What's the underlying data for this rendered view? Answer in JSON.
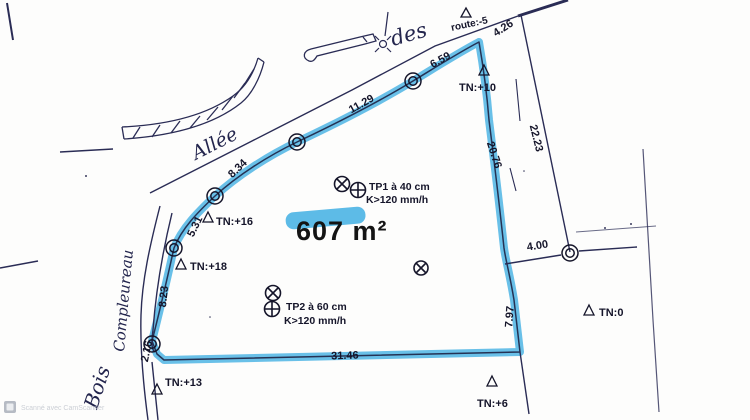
{
  "colors": {
    "highlighter": "#2fa8e0",
    "ink": "#23254d"
  },
  "parcel": {
    "area_label": "607 m²"
  },
  "labels": {
    "street_allee": "Allée",
    "street_des": "des",
    "street_bois": "Bois",
    "street_compleureau": "Compleureau",
    "route_note": "route:-5"
  },
  "measurements": [
    "4.26",
    "6.59",
    "11.29",
    "8.34",
    "5.31",
    "8.23",
    "2.16",
    "31.46",
    "7.97",
    "20.76",
    "22.23",
    "4.00"
  ],
  "elevations": [
    "TN:+10",
    "TN:+16",
    "TN:+18",
    "TN:+13",
    "TN:+6",
    "TN:0"
  ],
  "test_pits": {
    "tp1_line1": "TP1 à 40 cm",
    "tp1_line2": "K>120 mm/h",
    "tp2_line1": "TP2 à 60 cm",
    "tp2_line2": "K>120 mm/h"
  },
  "watermark": {
    "text": "Scanné avec CamScanner"
  }
}
